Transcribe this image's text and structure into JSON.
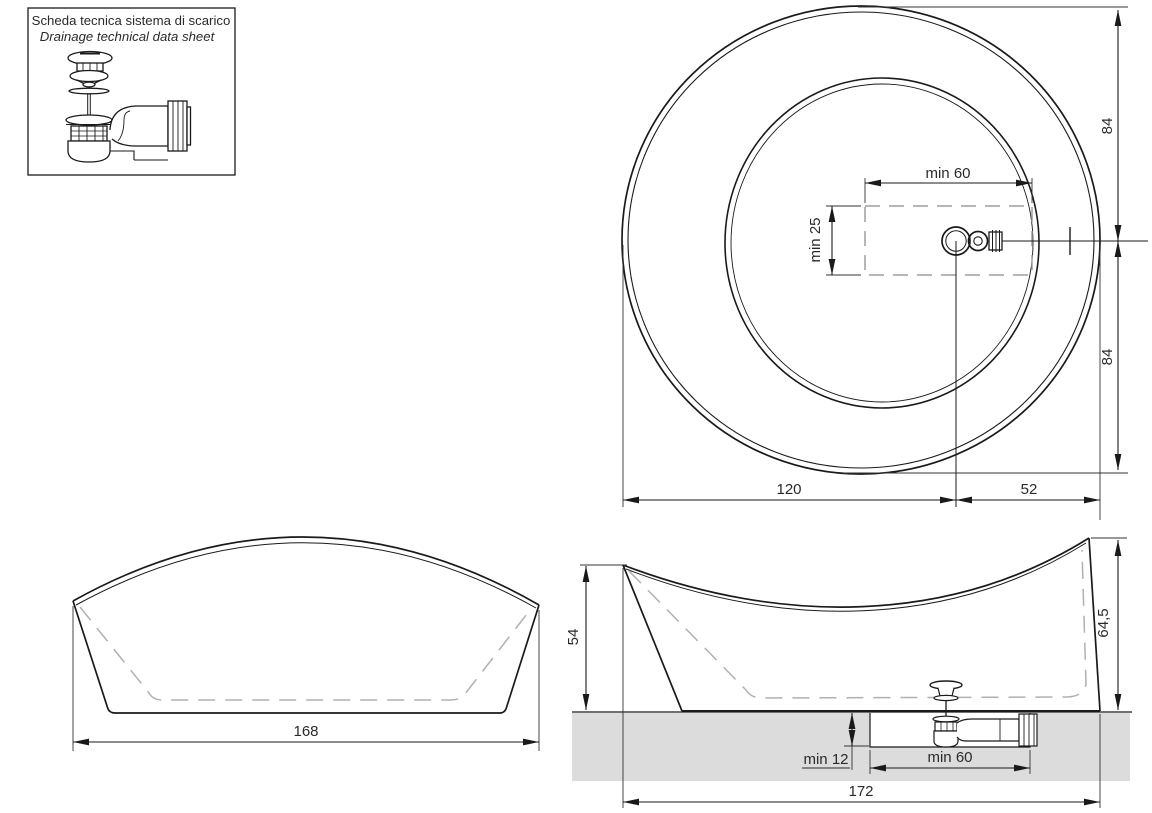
{
  "datasheet_box": {
    "title_it": "Scheda tecnica sistema di scarico",
    "title_en": "Drainage technical data sheet"
  },
  "plan_view": {
    "dim_drain_zone_width": "min  60",
    "dim_drain_zone_depth": "min 25",
    "dim_radius_top": "84",
    "dim_radius_bottom": "84",
    "dim_left_of_drain": "120",
    "dim_right_of_drain": "52"
  },
  "front_view": {
    "dim_width": "168"
  },
  "side_view": {
    "dim_height_left": "54",
    "dim_height_right": "64,5",
    "dim_recess_depth": "min 12",
    "dim_recess_width": "min 60",
    "dim_length": "172"
  },
  "icons": {
    "drain_assembly": "exploded pop-up waste with siphon trap",
    "drain_plan": "drain and overflow connection seen from above",
    "drain_trap_side": "pop-up waste with under-floor siphon trap"
  },
  "colors": {
    "line": "#1a1a1a",
    "thin_line": "#333333",
    "dashed": "#b0b0b0",
    "floor_fill": "#dcdcdc",
    "background": "#ffffff"
  }
}
